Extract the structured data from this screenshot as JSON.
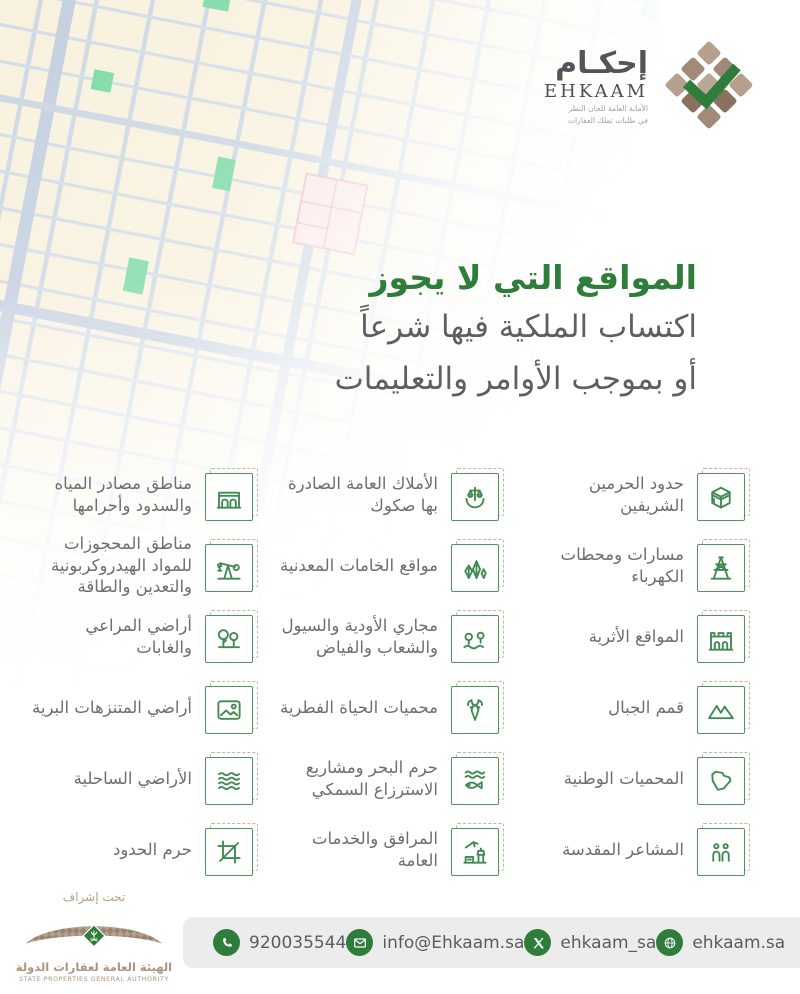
{
  "logo": {
    "arabic": "إحكـام",
    "latin": "EHKAAM",
    "tagline_line1": "الأمانة العامة للجان النظر",
    "tagline_line2": "في طلبات تملك العقارات"
  },
  "title": {
    "line1": "المواقع التي لا يجوز",
    "line2": "اكتساب الملكية فيها شرعاً",
    "line3": "أو بموجب الأوامر والتعليمات"
  },
  "grid": {
    "items": [
      {
        "icon": "kaaba-icon",
        "label": "حدود الحرمين الشريفين"
      },
      {
        "icon": "justice-scales-icon",
        "label": "الأملاك العامة الصادرة بها صكوك"
      },
      {
        "icon": "dam-icon",
        "label": "مناطق مصادر المياه والسدود وأحرامها"
      },
      {
        "icon": "electricity-pylon-icon",
        "label": "مسارات ومحطات الكهرباء"
      },
      {
        "icon": "minerals-icon",
        "label": "مواقع الخامات المعدنية"
      },
      {
        "icon": "oil-pump-icon",
        "label": "مناطق المحجوزات للمواد الهيدروكربونية والتعدين والطاقة"
      },
      {
        "icon": "heritage-building-icon",
        "label": "المواقع الأثرية"
      },
      {
        "icon": "valley-stream-icon",
        "label": "مجاري الأودية والسيول والشعاب والفياض"
      },
      {
        "icon": "forest-trees-icon",
        "label": "أراضي المراعي والغابات"
      },
      {
        "icon": "mountain-peaks-icon",
        "label": "قمم الجبال"
      },
      {
        "icon": "deer-icon",
        "label": "محميات الحياة الفطرية"
      },
      {
        "icon": "park-landscape-icon",
        "label": "أراضي المتنزهات البرية"
      },
      {
        "icon": "saudi-map-icon",
        "label": "المحميات الوطنية"
      },
      {
        "icon": "fish-waves-icon",
        "label": "حرم البحر ومشاريع الاسترزاع السمكي"
      },
      {
        "icon": "coastal-waves-icon",
        "label": "الأراضي الساحلية"
      },
      {
        "icon": "pilgrims-icon",
        "label": "المشاعر المقدسة"
      },
      {
        "icon": "public-facilities-icon",
        "label": "المرافق والخدمات العامة"
      },
      {
        "icon": "border-strip-icon",
        "label": "حرم الحدود"
      }
    ]
  },
  "supervision": {
    "label": "تحت إشراف",
    "authority_ar": "الهيئة العامة لعقارات الدولة",
    "authority_en": "STATE PROPERTIES GENERAL AUTHORITY"
  },
  "footer": {
    "phone": "920035544",
    "email": "info@Ehkaam.sa",
    "twitter": "ehkaam_sa",
    "website": "ehkaam.sa"
  },
  "colors": {
    "brand_green": "#2f7d3b",
    "icon_green": "#418a52",
    "brand_tan": "#a8927e",
    "text_gray": "#6d6e71",
    "footer_bg": "#ececec",
    "map_block": "#f8f1dd",
    "map_street": "#cdd8e4"
  }
}
